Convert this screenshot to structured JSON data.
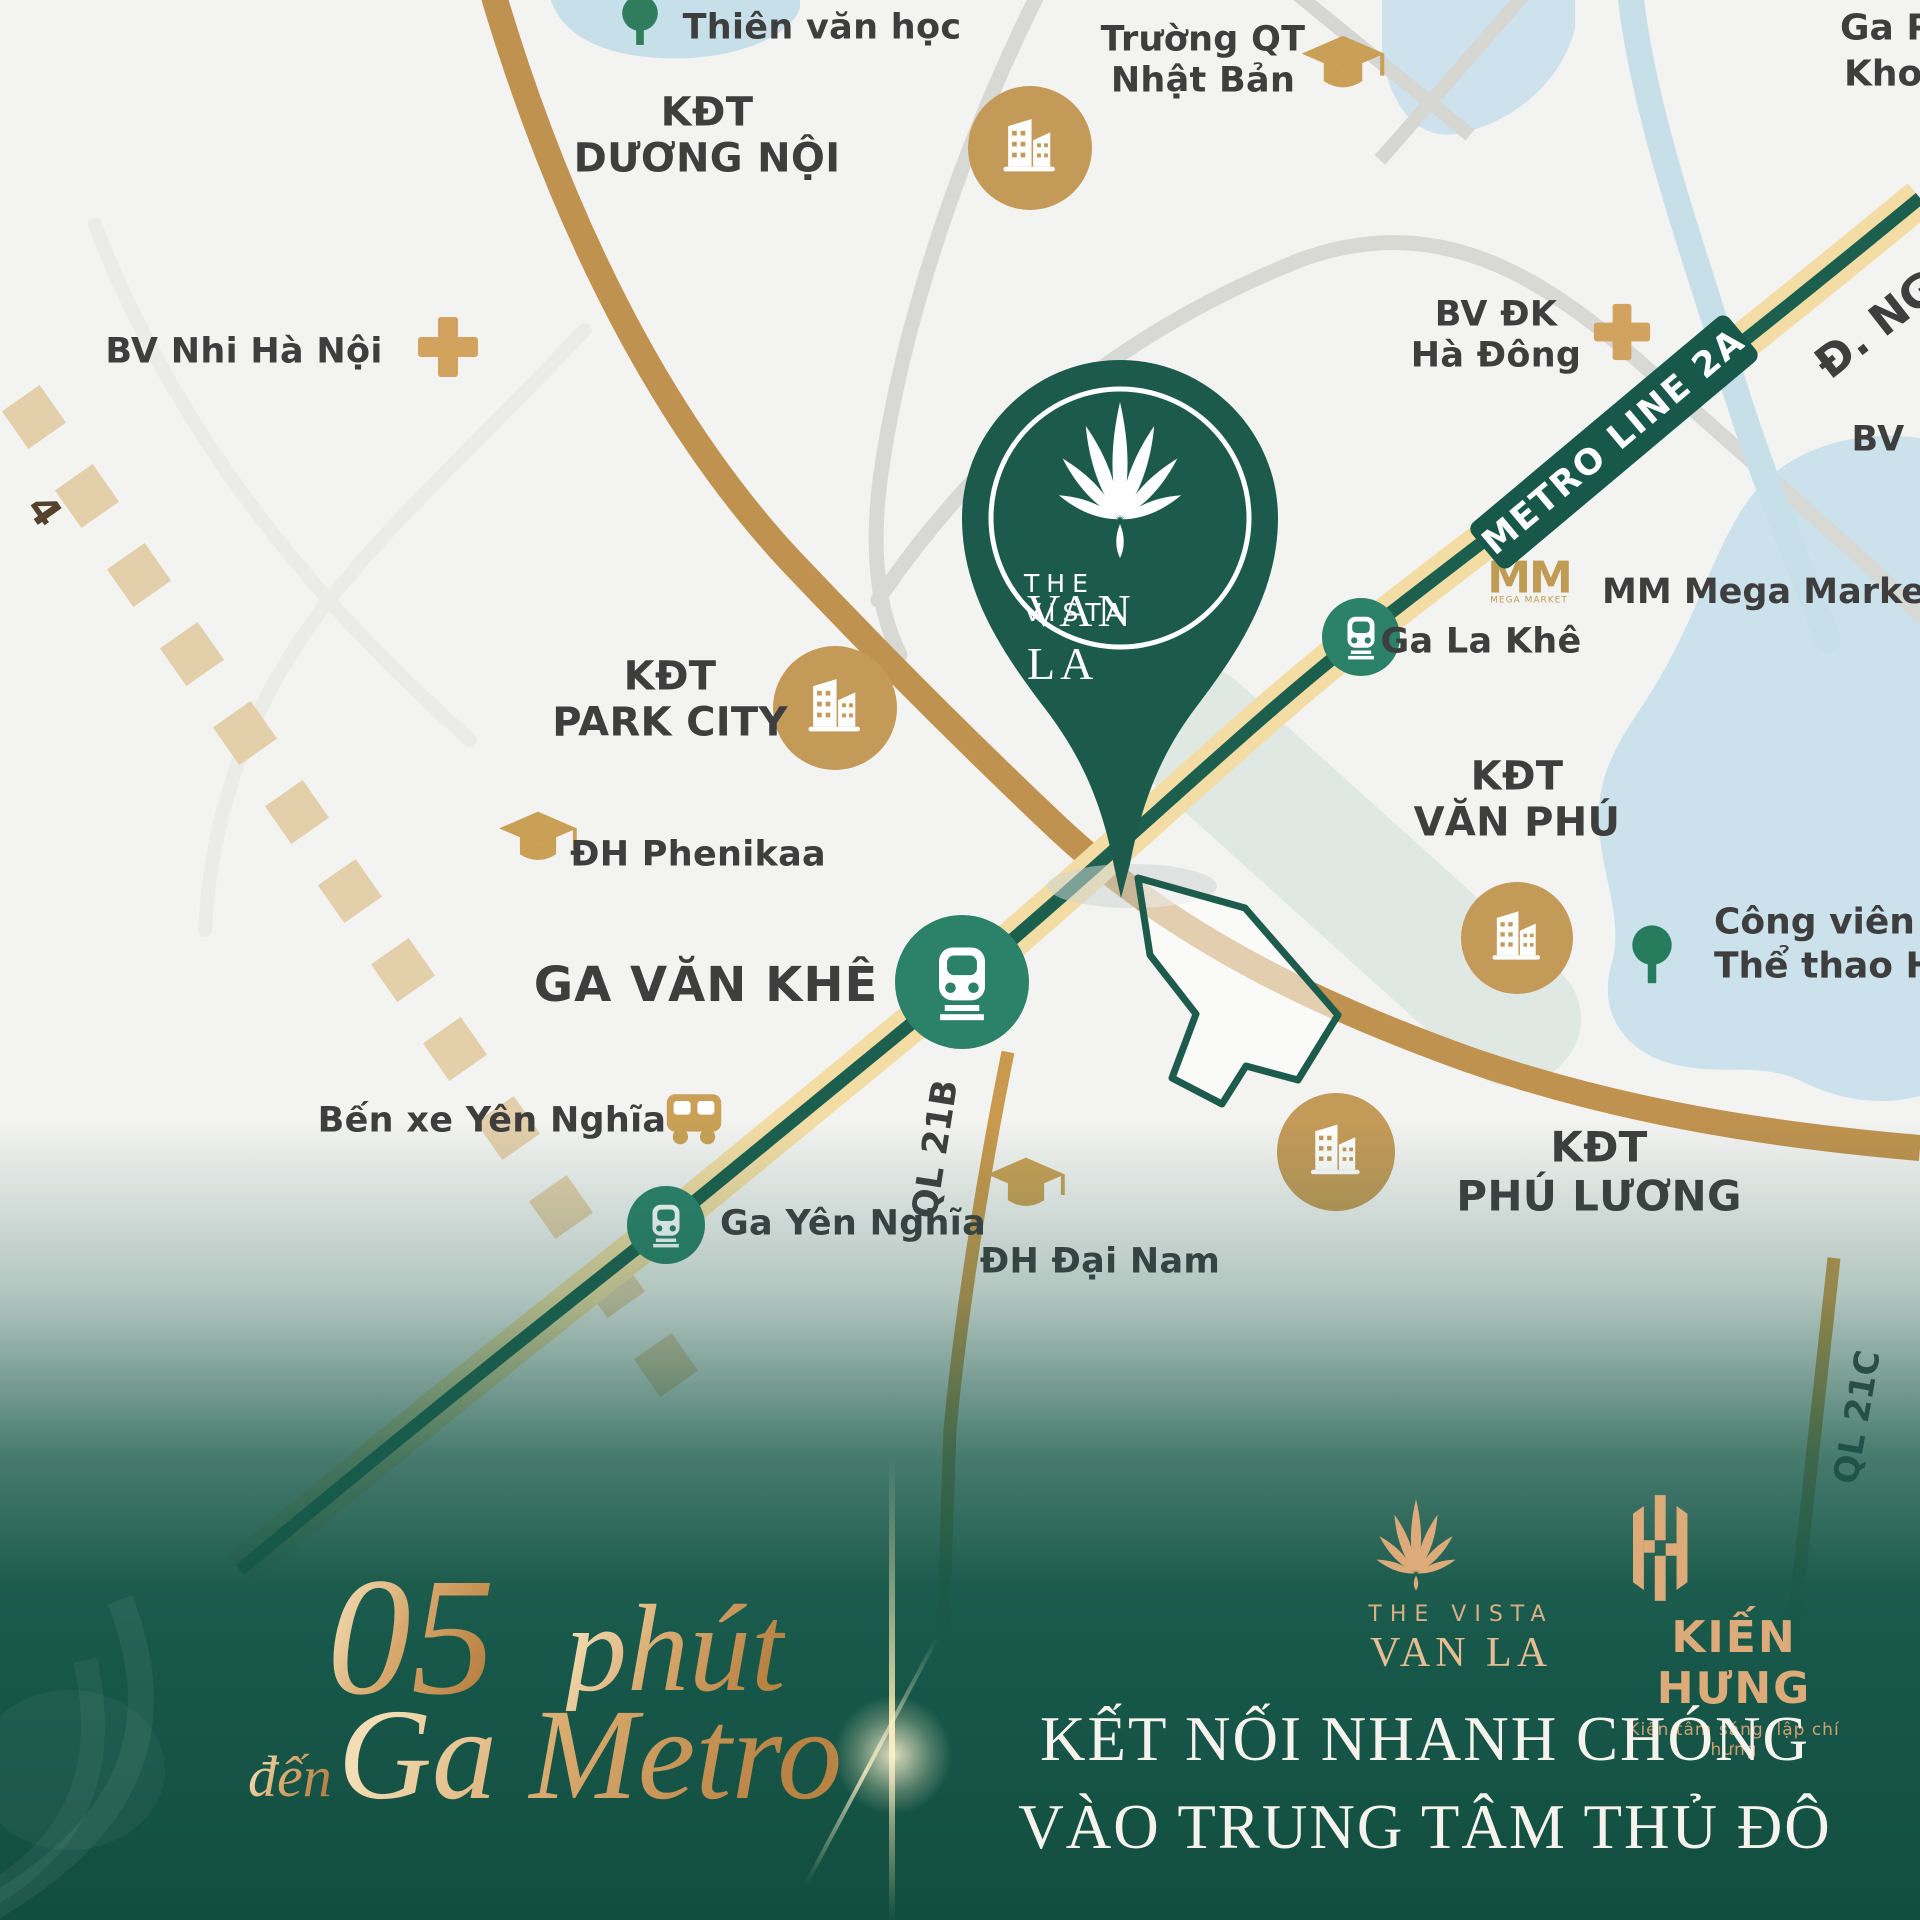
{
  "map": {
    "labels": {
      "thien_van_hoc": "Thiên văn học",
      "truong_qt_l1": "Trường QT",
      "truong_qt_l2": "Nhật Bản",
      "ga_phung_l1": "Ga Ph",
      "ga_phung_l2": "Khoa",
      "kdt_duong_noi_l1": "KĐT",
      "kdt_duong_noi_l2": "DƯƠNG NỘI",
      "bv_nhi": "BV Nhi Hà Nội",
      "bv_dk_l1": "BV ĐK",
      "bv_dk_l2": "Hà Đông",
      "bv_cut": "BV",
      "d_nguyen": "Đ. NG",
      "metro_badge": "METRO LINE 2A",
      "mm_glyph": "MM",
      "mm_glyph_sub": "MEGA MARKET",
      "mm_market": "MM Mega Market",
      "ga_la_khe": "Ga La Khê",
      "kdt_van_phu_l1": "KĐT",
      "kdt_van_phu_l2": "VĂN PHÚ",
      "cong_vien_l1": "Công viên",
      "cong_vien_l2": "Thể thao Hà",
      "kdt_park_city_l1": "KĐT",
      "kdt_park_city_l2": "PARK CITY",
      "dh_phenikaa": "ĐH Phenikaa",
      "ga_van_khe": "GA VĂN KHÊ",
      "ben_xe": "Bến xe Yên Nghĩa",
      "ga_yen_nghia": "Ga Yên Nghĩa",
      "dh_dai_nam": "ĐH Đại Nam",
      "ql21b": "QL 21B",
      "ql21c": "QL 21C",
      "kdt_phu_luong_l1": "KĐT",
      "kdt_phu_luong_l2": "PHÚ LƯƠNG",
      "road4": "4"
    },
    "pin": {
      "l1": "THE VISTA",
      "l2": "VAN LA"
    }
  },
  "footer": {
    "minutes": "05",
    "minutes_word": "phút",
    "to_word": "đến",
    "destination": "Ga Metro",
    "slogan_l1": "KẾT NỐI NHANH CHÓNG",
    "slogan_l2": "VÀO TRUNG TÂM THỦ ĐÔ",
    "vista_logo_l1": "THE VISTA",
    "vista_logo_l2": "VAN LA",
    "kien_hung_name": "KIẾN HƯNG",
    "kien_hung_tagline": "Kiến tâm sáng, lập chí hưng"
  },
  "colors": {
    "pin_green": "#1c5b4b",
    "metro_green": "#1c5f4e",
    "metro_tan": "#f3dda4",
    "icon_gold": "#c49a58",
    "road_gold": "#c0924f",
    "water_blue": "#c7dfe9",
    "footer_green": "#17584a",
    "gold_text": "#d9ad7a",
    "label_gray": "#3e3e3e"
  }
}
